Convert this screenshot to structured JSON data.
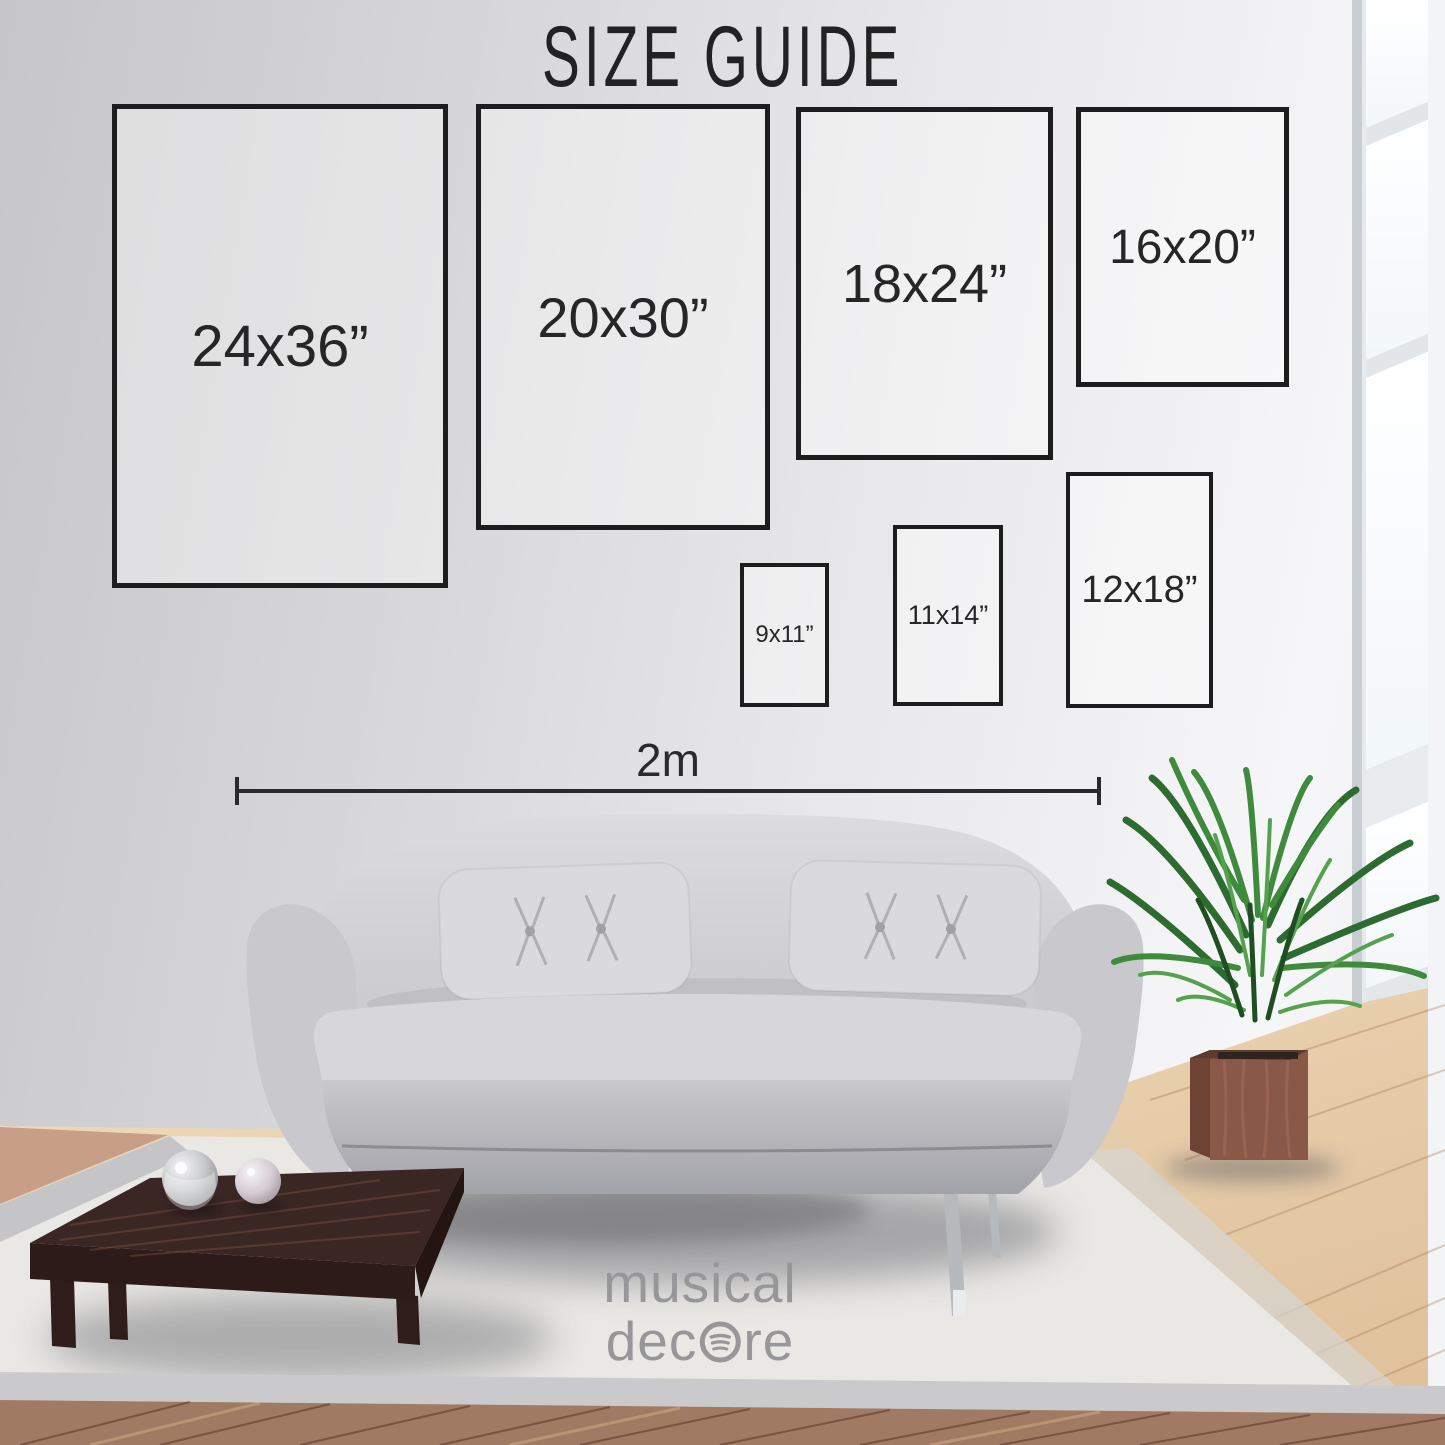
{
  "title": "SIZE GUIDE",
  "size_boxes": [
    {
      "id": "24x36",
      "label": "24x36”"
    },
    {
      "id": "20x30",
      "label": "20x30”"
    },
    {
      "id": "18x24",
      "label": "18x24”"
    },
    {
      "id": "16x20",
      "label": "16x20”"
    },
    {
      "id": "9x11",
      "label": "9x11”"
    },
    {
      "id": "11x14",
      "label": "11x14”"
    },
    {
      "id": "12x18",
      "label": "12x18”"
    }
  ],
  "scale_bar": {
    "label": "2m"
  },
  "brand": {
    "line1": "musical",
    "line2_pre": "dec",
    "line2_post": "re",
    "icon": "spotify-style-circle-icon"
  },
  "colors": {
    "outline": "#1d1d1d",
    "text": "#262626",
    "wall_light": "#f6f6f8",
    "wall_dark": "#c6c6c9",
    "sofa": "#d2d2d5",
    "rug": "#e9e8e5",
    "table_wood": "#3a2724",
    "floor_wood": "#e6cba6",
    "plant_green": "#3f8a3c",
    "logo_gray": "#97979a"
  }
}
